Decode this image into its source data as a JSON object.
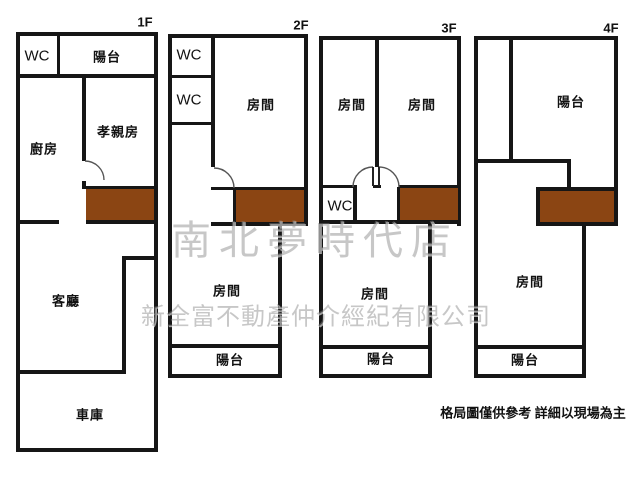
{
  "title": "floor-plan",
  "note": "格局圖僅供參考 詳細以現場為主",
  "watermark": {
    "store_name": "南北夢時代店",
    "company_name": "新全富不動產仲介經紀有限公司"
  },
  "colors": {
    "wall": "#161616",
    "stairs": "#8B4513",
    "background": "#ffffff",
    "watermark_gray": "#828282",
    "text": "#111111"
  },
  "floors": [
    {
      "label": "1F",
      "rooms": [
        {
          "name": "wc",
          "label": "WC"
        },
        {
          "name": "balcony-front",
          "label": "陽台"
        },
        {
          "name": "kitchen",
          "label": "廚房"
        },
        {
          "name": "parents-room",
          "label": "孝親房"
        },
        {
          "name": "living-room",
          "label": "客廳"
        },
        {
          "name": "garage",
          "label": "車庫"
        }
      ]
    },
    {
      "label": "2F",
      "rooms": [
        {
          "name": "wc-upper",
          "label": "WC"
        },
        {
          "name": "wc-lower",
          "label": "WC"
        },
        {
          "name": "room-front",
          "label": "房間"
        },
        {
          "name": "room-rear",
          "label": "房間"
        },
        {
          "name": "balcony-rear",
          "label": "陽台"
        }
      ]
    },
    {
      "label": "3F",
      "rooms": [
        {
          "name": "room-front-left",
          "label": "房間"
        },
        {
          "name": "room-front-right",
          "label": "房間"
        },
        {
          "name": "wc",
          "label": "WC"
        },
        {
          "name": "room-rear",
          "label": "房間"
        },
        {
          "name": "balcony-rear",
          "label": "陽台"
        }
      ]
    },
    {
      "label": "4F",
      "rooms": [
        {
          "name": "balcony-front",
          "label": "陽台"
        },
        {
          "name": "room-rear",
          "label": "房間"
        },
        {
          "name": "balcony-rear",
          "label": "陽台"
        }
      ]
    }
  ]
}
